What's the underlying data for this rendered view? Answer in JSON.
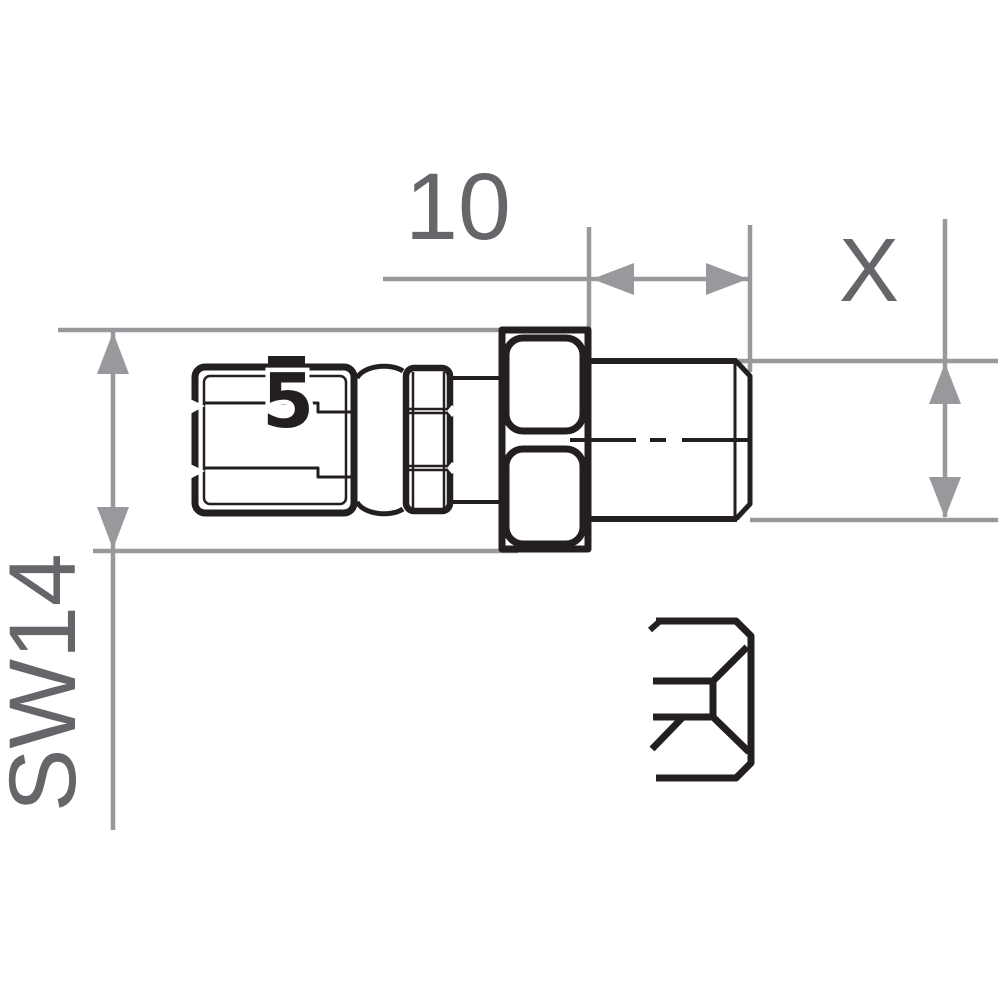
{
  "drawing": {
    "kind": "hose-fitting-technical-drawing",
    "labels": {
      "length_dimension": "10",
      "thread_dimension": "X",
      "wrench_size": "SW14",
      "socket_marking": "5"
    },
    "symbols": [
      {
        "name": "female-cone-symbol"
      }
    ]
  },
  "colors": {
    "background": "#ffffff",
    "part_line": "#231f20",
    "dimension_line": "#97999c",
    "label_text": "#65666a"
  }
}
